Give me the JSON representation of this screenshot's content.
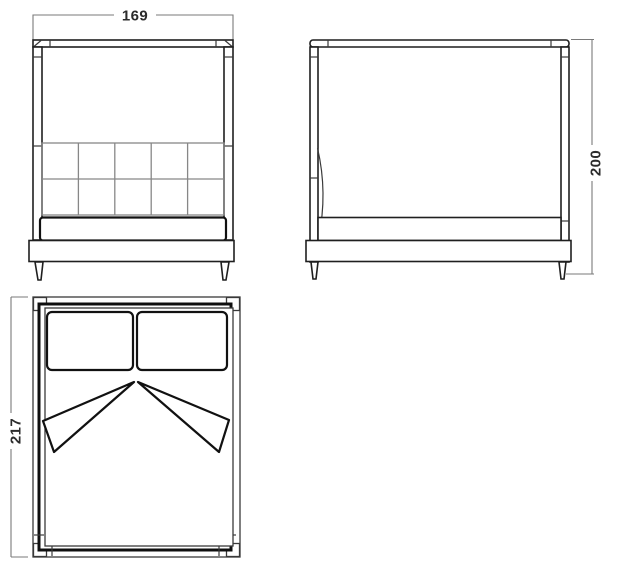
{
  "drawing": {
    "front_view": {
      "width_label": "169"
    },
    "side_view": {
      "height_label": "200"
    },
    "plan_view": {
      "depth_label": "217"
    }
  },
  "colors": {
    "background": "#ffffff",
    "outline": "#1f1f1f",
    "grid": "#878787",
    "dimension_line": "#7a7a7a",
    "label_text": "#2b2b2b"
  }
}
